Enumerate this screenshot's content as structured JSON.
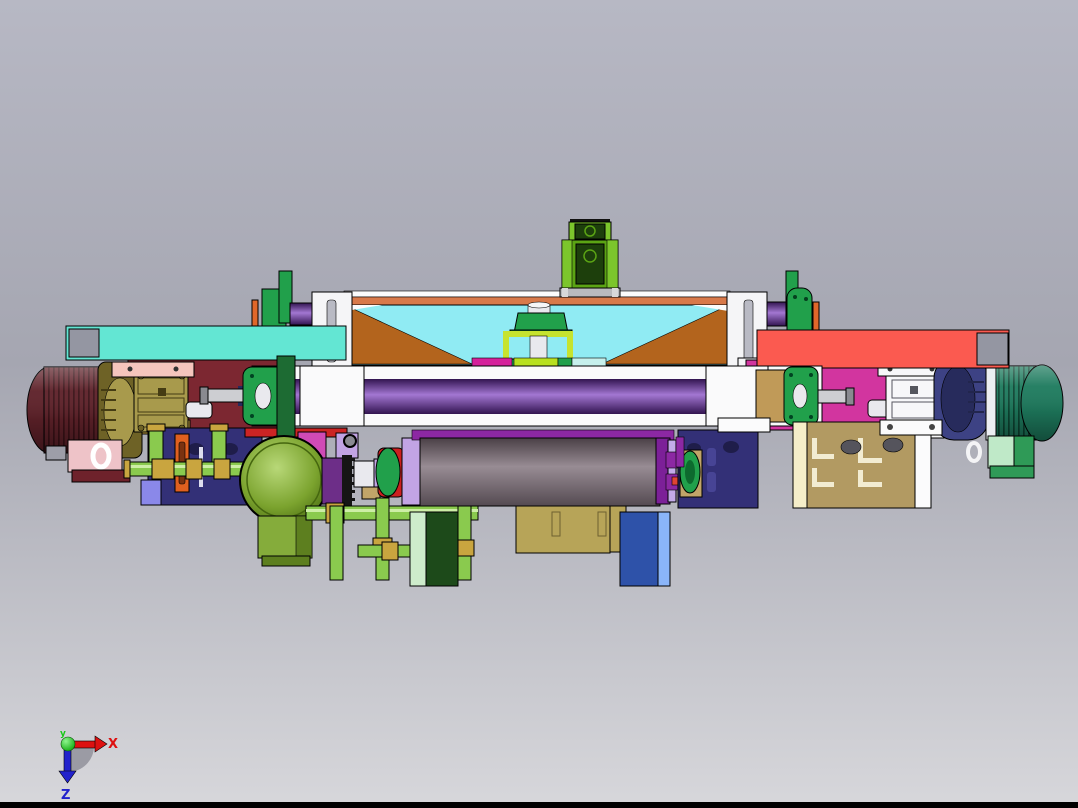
{
  "scene": {
    "type": "cad-3d-assembly-view",
    "description": "Side view of a roller machine assembly with left and right motor-gearbox drives"
  },
  "axis_triad": {
    "x_label": "X",
    "y_label": "y",
    "z_label": "Z"
  },
  "colors": {
    "bgTop": "#b7b8c4",
    "bgMid": "#a5a6b1",
    "bgBot": "#d7d7db",
    "black": "#000000",
    "cyanBar": "#63e6d3",
    "redBar": "#fb5a50",
    "barGray": "#9496a2",
    "maroonBeam": "#7c2731",
    "magentaBeam": "#d2359f",
    "orangeBeam": "#d8794a",
    "plateCyan": "#90ebf3",
    "triBrown": "#b3641d",
    "colWhite": "#f5f5f7",
    "colSlot": "#b9bac4",
    "white": "#fbfbfc",
    "green": "#21a04b",
    "greenDark": "#0f6e31",
    "purpleMid": "#7a4aae",
    "purpleDark": "#321450",
    "purpleLite": "#a377d2",
    "orangeSliver": "#e0672a",
    "salmonStrip": "#ef9a7e",
    "topGreen": "#5ba414",
    "topGreenDark": "#1d3f0c",
    "topGreenLite": "#7cc62c",
    "baseGray": "#b9b9bd",
    "frameYellow": "#c6e32f",
    "cylWhite": "#e9e9ee",
    "stripMagenta": "#d5219b",
    "stripYellow": "#b8e020",
    "stripCyan": "#c6f0ec",
    "rollerWhite": "#fafafb",
    "tanDisc": "#c09a58",
    "shaftSilver": "#cdced2",
    "shaftDark": "#898a90",
    "motorMaroon": "#5e2129",
    "motorMaroonFin": "#3a1217",
    "pinkRing": "#cf9fa6",
    "gboxOlive": "#a89a4c",
    "gboxOliveDark": "#6e6226",
    "gboxRib": "#453c13",
    "salmonPlate": "#f5c5bd",
    "pinkBracket": "#eec3c8",
    "maroonFoot": "#6e222b",
    "boltGray": "#9d9ea8",
    "motorTeal": "#1e7b5e",
    "motorTealFin": "#0d4533",
    "gboxNavy": "#3d4284",
    "gboxNavyDark": "#272b5c",
    "ringWhite": "#eceef2",
    "gboxWhite": "#f7f7f9",
    "brLightGreen": "#bfe9c8",
    "brGreen": "#2f9a57",
    "navyPanel": "#333077",
    "navyHole": "#1f1d4a",
    "navySlot": "#474495",
    "periwinkle": "#8a88e9",
    "oliveDisc": "#7ba32e",
    "oliveDiscDark": "#45660f",
    "oliveBlock": "#85ac3b",
    "oliveBlockDark": "#5d7f1f",
    "pipeGreen": "#8aca4e",
    "pipeLite": "#cdeea6",
    "couplingTan": "#c9a53f",
    "magentaSmall": "#d04ab6",
    "lavender": "#c2a4e4",
    "purpleHub": "#6d2e88",
    "rollerBand": "#8c28a3",
    "purpleCap": "#7c2098",
    "lavenderRing": "#c3abe9",
    "redDot": "#e04434",
    "bearTan": "#c1a569",
    "darkGreenBlock": "#1d4a1a",
    "lightGreenEdge": "#cdeccb",
    "tanBlock": "#b7a458",
    "blueBlock": "#2e52a9",
    "blueLite": "#8ab5f9",
    "plateTan": "#b29a62",
    "plateCream": "#f5eec9",
    "orangeBracket": "#e0601f",
    "orangeBracketSlot": "#7a3210",
    "redStrip": "#cc2424",
    "greenArm": "#1d6b33",
    "rollerGrayTop": "#4a4046",
    "rollerGrayMid": "#988c94",
    "rollerGrayBot": "#544a51",
    "axisRed": "#dd1111",
    "axisBlue": "#2222cc",
    "axisGreen": "#19c819",
    "quadGray": "#9b9ba4"
  }
}
